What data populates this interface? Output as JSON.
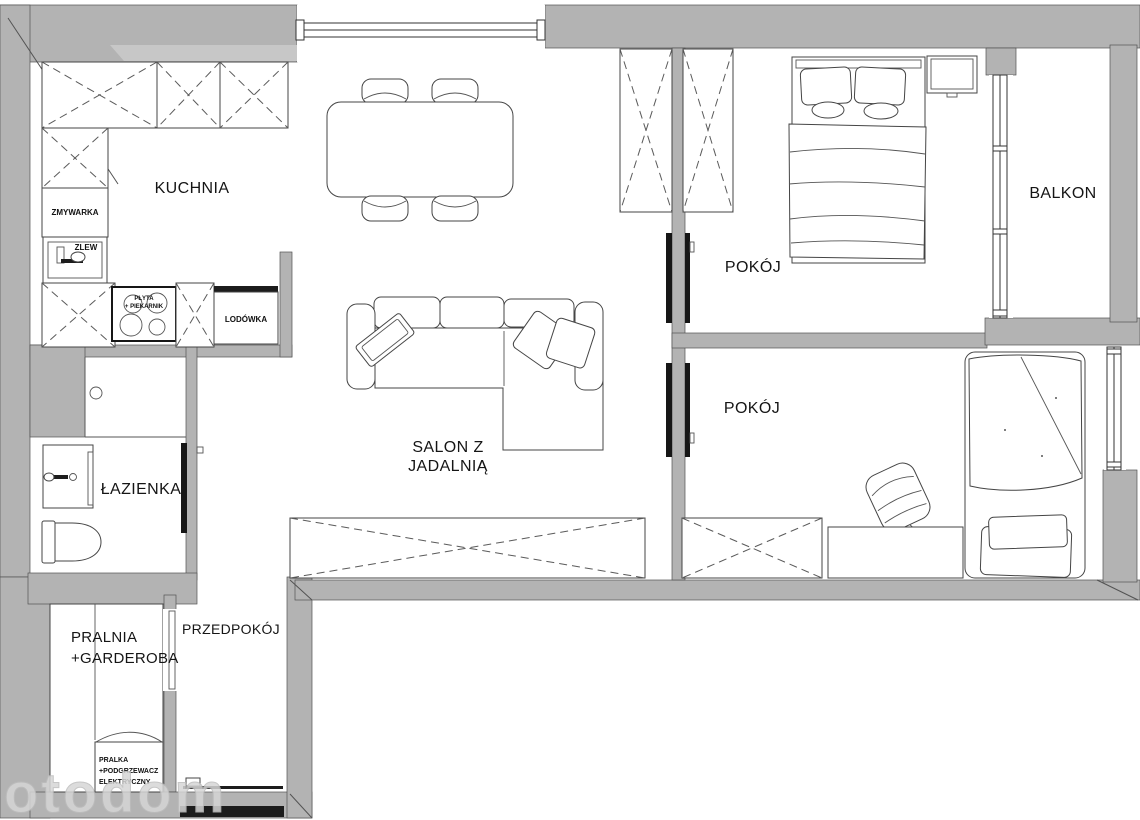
{
  "fp": {
    "labels": {
      "kitchen": "KUCHNIA",
      "salon_line1": "SALON Z",
      "salon_line2": "JADALNIĄ",
      "bedroom1": "POKÓJ",
      "bedroom2": "POKÓJ",
      "balcony": "BALKON",
      "bathroom": "ŁAZIENKA",
      "hallway": "PRZEDPOKÓJ",
      "laundry_line1": "PRALNIA",
      "laundry_line2": "+GARDEROBA",
      "dishwasher": "ZMYWARKA",
      "sink": "ZLEW",
      "hob_line1": "PŁYTA",
      "hob_line2": "+ PIEKARNIK",
      "fridge": "LODÓWKA",
      "washer_line1": "PRALKA",
      "washer_line2": "+PODGRZEWACZ",
      "washer_line3": "ELEKTRYCZNY"
    },
    "watermark": "otodom",
    "colors": {
      "wall": "#b3b3b3",
      "wall_light": "#c7c7c7",
      "outline": "#535353",
      "floor": "#ffffff",
      "door": "#161616",
      "text": "#151515",
      "watermark": "#d6d6d6"
    }
  }
}
